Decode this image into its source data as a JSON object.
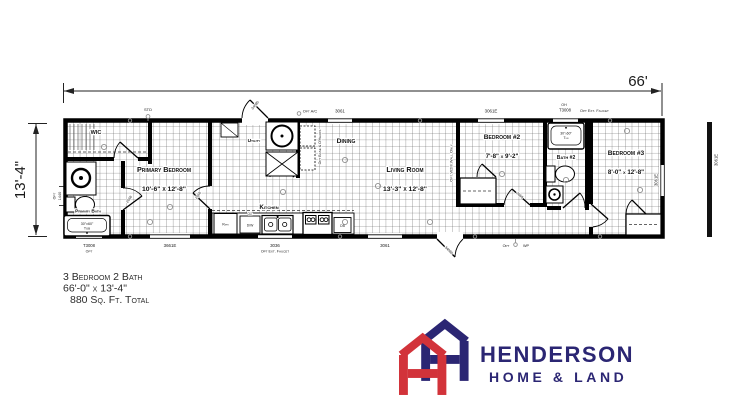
{
  "plan": {
    "dim_width": "66'",
    "dim_height": "13'-4\"",
    "rooms": {
      "wic": "WIC",
      "primary_bedroom": "Primary Bedroom",
      "primary_bedroom_dims": "10'-6\" x 12'-8\"",
      "primary_bath": "Primary Bath",
      "utility": "Utility",
      "dining": "Dining",
      "kitchen": "Kitchen",
      "living": "Living Room",
      "living_dims": "13'-3\" x 12'-8\"",
      "bedroom2": "Bedroom #2",
      "bedroom2_dims": "7'-8\" x 9'-2\"",
      "bath2": "Bath #2",
      "bedroom3": "Bedroom #3",
      "bedroom3_dims": "8'-0\" x 12'-8\""
    },
    "fixtures": {
      "tub_size": "30\"x60\"",
      "tub_word": "Tub",
      "tub2_size": "30\"x60\"",
      "tub2_word": "Tub",
      "refr": "Refr",
      "dw": "D/W",
      "dw_opt": "Opt",
      "db": "DB"
    },
    "windows": {
      "w3061_top": "3061",
      "w3061e_top": "3061E",
      "oh": "OH",
      "t3008_top": "T3008",
      "faucet_top": "Opt Ext. Faucet",
      "t3008_bottom": "T3008",
      "opt_bottom": "Opt",
      "w3661e": "3661E",
      "w3036": "3036",
      "faucet_bottom": "Opt Ext. Faucet",
      "w3061_bottom": "3061",
      "w3061e_right": "3061E",
      "w3061e_side": "3061E",
      "opt_left": "Opt",
      "w1440_left": "1440"
    },
    "notes": {
      "std": "STD",
      "opt_ac": "Opt A/C",
      "opt_wp_l": "Opt",
      "opt_wp_r": "WP",
      "opt_wall": "Opt W2III Wall Only",
      "opt_base": "Opt Base & O'Heads",
      "door_front": "34080",
      "door_back": "34080",
      "door_a": "2668",
      "door_b": "2668",
      "door_c": "2668"
    }
  },
  "description": {
    "line1": "3 Bedroom 2 Bath",
    "line2": "66'-0\" x 13'-4\"",
    "line3": "880 Sq. Ft. Total"
  },
  "logo": {
    "name": "HENDERSON",
    "tagline": "HOME & LAND",
    "navy": "#2B2673",
    "red": "#D2333A"
  }
}
